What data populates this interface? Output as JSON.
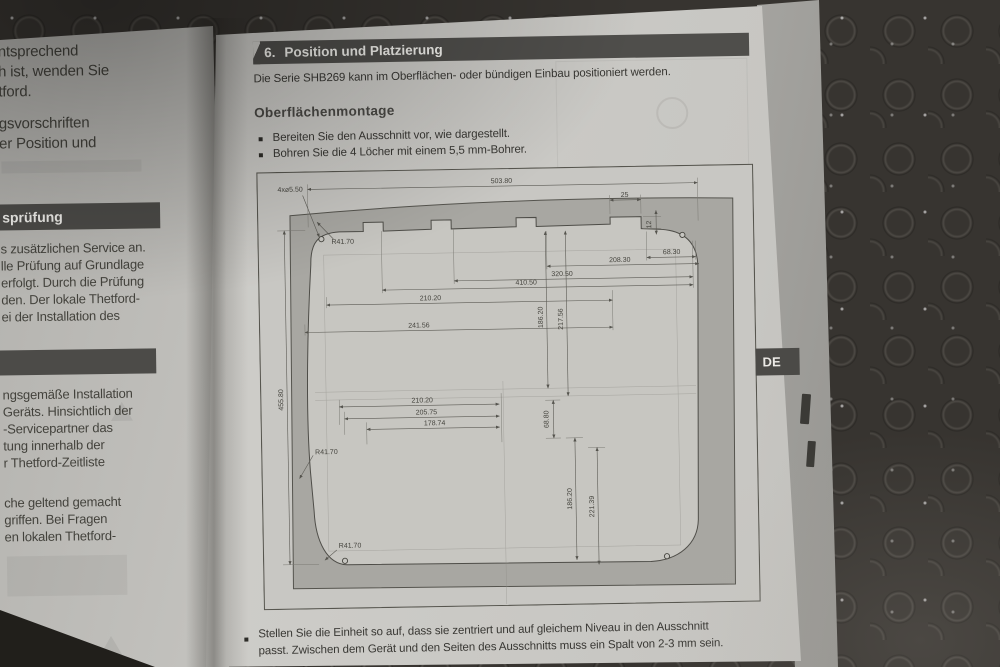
{
  "left_page": {
    "block1": [
      "ntsprechend",
      "h ist, wenden Sie",
      "tford."
    ],
    "block2": [
      "gsvorschriften",
      "er Position und"
    ],
    "banner1": "sprüfung",
    "block3": [
      "s zusätzlichen Service an.",
      "lle Prüfung auf Grundlage",
      "erfolgt. Durch die Prüfung",
      "den. Der lokale Thetford-",
      "ei der Installation des"
    ],
    "block4": [
      "ngsgemäße Installation",
      "Geräts. Hinsichtlich der",
      "-Servicepartner das",
      "tung innerhalb der",
      "r Thetford-Zeitliste"
    ],
    "block5": [
      "che geltend gemacht",
      "griffen. Bei Fragen",
      "en lokalen Thetford-"
    ]
  },
  "right_page": {
    "section_number": "6.",
    "section_title": "Position und Platzierung",
    "intro": "Die Serie SHB269 kann im Oberflächen- oder bündigen Einbau positioniert werden.",
    "subheading": "Oberflächenmontage",
    "bullet1": "Bereiten Sie den Ausschnitt vor, wie dargestellt.",
    "bullet2": "Bohren Sie die 4 Löcher mit einem 5,5 mm-Bohrer.",
    "bottom_bullet_line1": "Stellen Sie die Einheit so auf, dass sie zentriert und auf gleichem Niveau in den Ausschnitt",
    "bottom_bullet_line2": "passt. Zwischen dem Gerät und den Seiten des Ausschnitts muss ein Spalt von 2-3 mm sein.",
    "language_tab": "DE"
  },
  "drawing": {
    "dims": {
      "holes_note": "4x⌀5.50",
      "width_total": "503.80",
      "notch_w": "25",
      "notch_d": "12",
      "d68_30": "68.30",
      "d208_30": "208.30",
      "d320_50": "320.50",
      "d410_50": "410.50",
      "d210_20_top": "210.20",
      "d241_56": "241.56",
      "d186_20_top": "186.20",
      "d217_56": "217.56",
      "height_total": "455.80",
      "d210_20_low": "210.20",
      "d205_75": "205.75",
      "d178_74": "178.74",
      "d68_80": "68.80",
      "d186_20_low": "186.20",
      "d221_39": "221.39",
      "radius_tl": "R41.70",
      "radius_ml": "R41.70",
      "radius_bl": "R41.70"
    }
  },
  "colors": {
    "banner": "#4f4e4b",
    "page": "#c9c8c4",
    "panel_fill": "#a8a7a2",
    "text": "#3a3935",
    "background": "#373430"
  }
}
